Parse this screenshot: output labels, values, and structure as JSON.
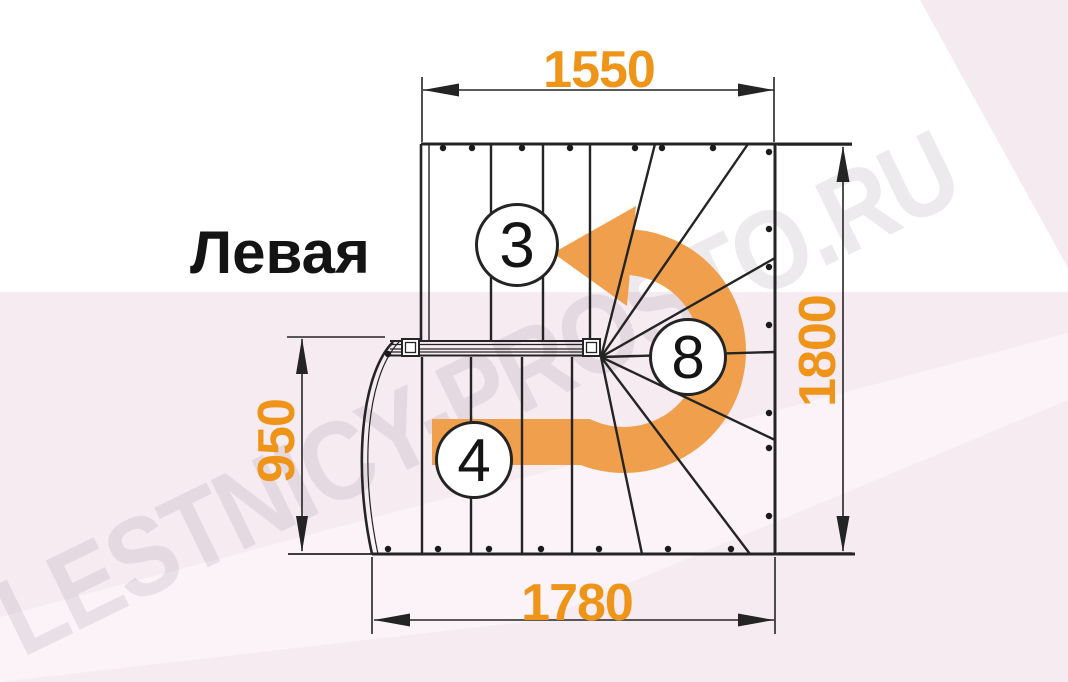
{
  "labels": {
    "orientation": "Левая"
  },
  "watermark": {
    "text": "LESTNICY-PROSTO.RU"
  },
  "dimensions": {
    "top_width": "1550",
    "total_depth": "1800",
    "lower_flight_depth": "950",
    "bottom_width": "1780"
  },
  "step_counts": {
    "upper_flight": "3",
    "winders": "8",
    "lower_flight": "4"
  },
  "turn_arrow": {
    "direction": "left-turn-180",
    "color": "#f0a04c"
  },
  "colors": {
    "dimension_text": "#ee9419",
    "drawing_line": "#242424",
    "background_tint": "#f6ebf1",
    "watermark_gray": "#8d8294"
  }
}
